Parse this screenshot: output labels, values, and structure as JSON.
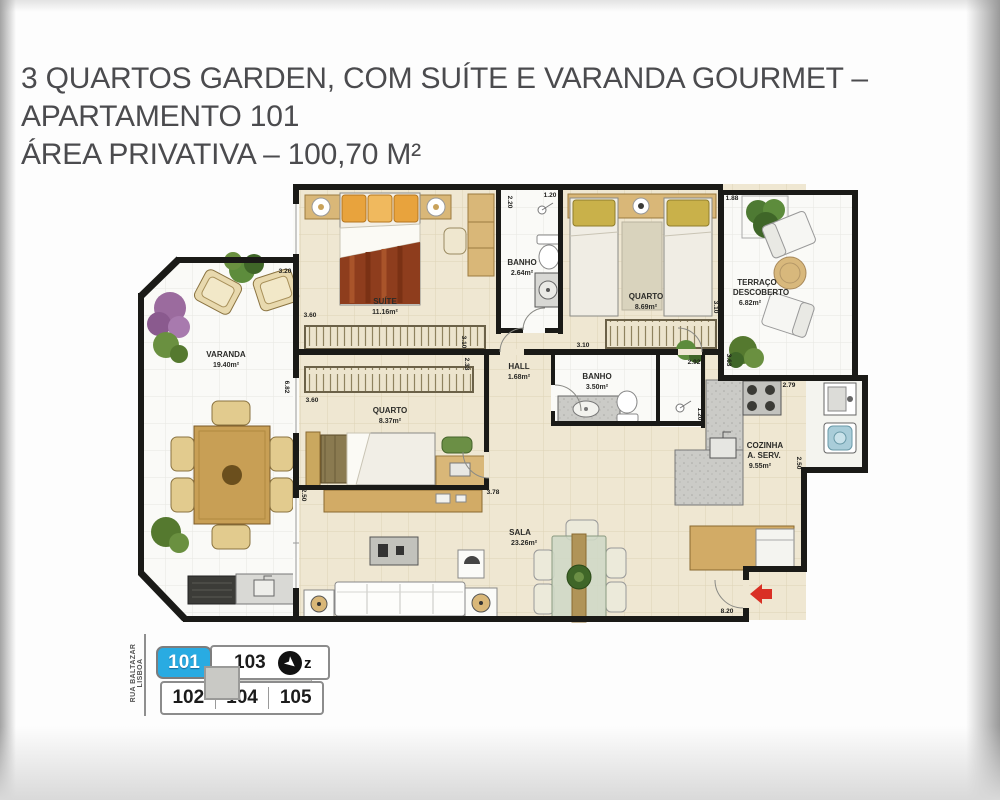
{
  "title": {
    "line1": "3 QUARTOS GARDEN, COM SUÍTE E VARANDA GOURMET –",
    "line2": "APARTAMENTO 101",
    "line3": "ÁREA PRIVATIVA – 100,70 M²"
  },
  "plan": {
    "rooms": {
      "suite": {
        "name": "SUÍTE",
        "area": "11.16m²"
      },
      "banho1": {
        "name": "BANHO",
        "area": "2.64m²"
      },
      "quarto1": {
        "name": "QUARTO",
        "area": "8.69m²"
      },
      "terraco": {
        "name1": "TERRAÇO",
        "name2": "DESCOBERTO",
        "area": "6.82m²"
      },
      "varanda": {
        "name": "VARANDA",
        "area": "19.40m²"
      },
      "quarto2": {
        "name": "QUARTO",
        "area": "8.37m²"
      },
      "hall": {
        "name": "HALL",
        "area": "1.68m²"
      },
      "banho2": {
        "name": "BANHO",
        "area": "3.50m²"
      },
      "cozinha": {
        "name1": "COZINHA",
        "name2": "A. SERV.",
        "area": "9.55m²"
      },
      "sala": {
        "name": "SALA",
        "area": "23.26m²"
      }
    },
    "dims": {
      "banho1_h": "2.20",
      "banho1_w": "1.20",
      "terraco_w": "1.88",
      "terraco_l": "3.63",
      "varanda_w": "3.20",
      "varanda_l": "6.82",
      "suite_w": "3.60",
      "suite_h": "3.10",
      "quarto1_h": "3.10",
      "mid_w": "3.10",
      "quarto2_w": "3.60",
      "quarto2_h": "2.33",
      "sala_l": "2.50",
      "sala_w": "3.78",
      "banho2_w": "2.92",
      "lavabo_w": "1.20",
      "cozinha_w": "2.79",
      "cozinha_h": "2.50",
      "entry_w": "8.20"
    }
  },
  "keyplan": {
    "street": "RUA BALTAZAR LISBOA",
    "units": [
      "101",
      "103",
      "102",
      "104",
      "105"
    ],
    "active_unit": "101",
    "north": "z"
  },
  "colors": {
    "accent_blue": "#29abe2",
    "arrow_red": "#d93025",
    "wall": "#1a1a17",
    "floor_cream": "#efe7d2",
    "wood": "#d2a75f"
  }
}
